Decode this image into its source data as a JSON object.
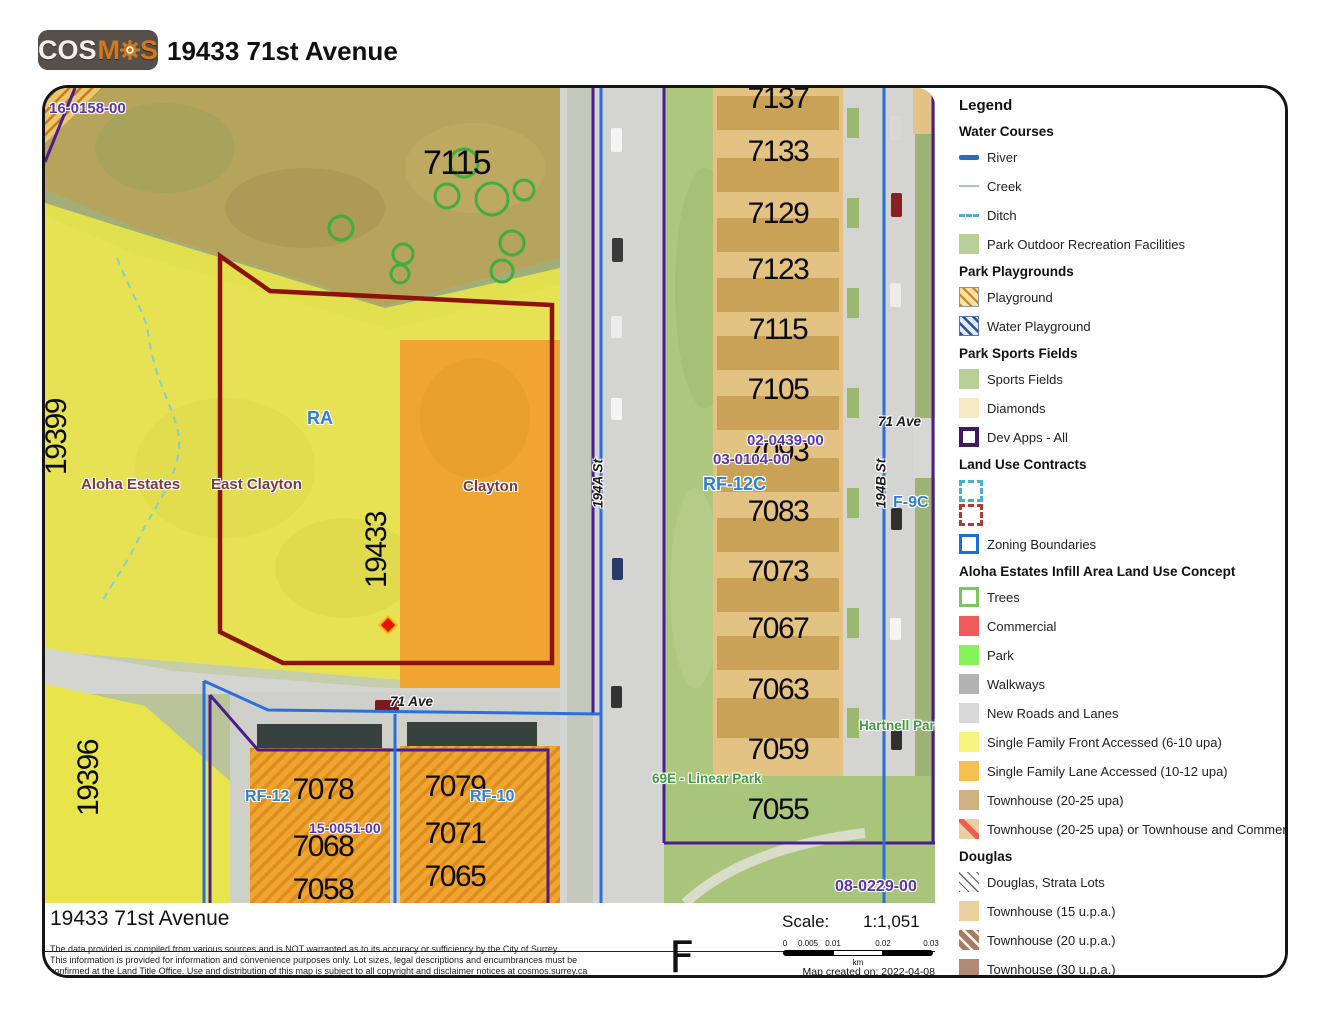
{
  "header": {
    "logo_part1": "COS",
    "logo_part2": "M",
    "logo_part3": "S",
    "title": "19433 71st Avenue"
  },
  "map": {
    "file_labels": {
      "nw": "16-0158-00",
      "c1": "02-0439-00",
      "c2": "03-0104-00",
      "sw": "15-0051-00",
      "se": "08-0229-00"
    },
    "zone_labels": {
      "ra": "RA",
      "rf12c": "RF-12C",
      "rf12": "RF-12",
      "rf10": "RF-10",
      "f9c": "F-9C"
    },
    "place_labels": {
      "aloha": "Aloha Estates",
      "east_clayton": "East Clayton",
      "clayton": "Clayton",
      "hartnell": "Hartnell Park",
      "linear_park": "69E - Linear Park"
    },
    "street_labels": {
      "s194a": "194A St",
      "s194b": "194B St",
      "ave71_right": "71 Ave",
      "ave71_bottom": "71 Ave"
    },
    "address_labels": {
      "a19399": "19399",
      "a19433": "19433",
      "a19396": "19396",
      "p7115_large": "7115"
    },
    "house_column": [
      "7137",
      "7133",
      "7129",
      "7123",
      "7115",
      "7105",
      "7093",
      "7083",
      "7073",
      "7067",
      "7063",
      "7059",
      "7055"
    ],
    "block_numbers": {
      "b7078": "7078",
      "b7068": "7068",
      "b7058": "7058",
      "b7079": "7079",
      "b7071": "7071",
      "b7065": "7065"
    }
  },
  "legend": {
    "title": "Legend",
    "sections": [
      {
        "header": "Water Courses",
        "items": [
          {
            "label": "River",
            "swatch": "river-line",
            "color": "#2b6cb8"
          },
          {
            "label": "Creek",
            "swatch": "creek-line",
            "color": "#9fc9d4"
          },
          {
            "label": "Ditch",
            "swatch": "ditch-dashed-line",
            "color": "#58a8da"
          },
          {
            "label": "Park Outdoor Recreation Facilities",
            "swatch": "fill",
            "color": "#b9cf97"
          }
        ]
      },
      {
        "header": "Park Playgrounds",
        "items": [
          {
            "label": "Playground",
            "swatch": "yellow-hatch",
            "color": "#f3e3a8"
          },
          {
            "label": "Water Playground",
            "swatch": "blue-hatch",
            "color": "#dfe9f5"
          }
        ]
      },
      {
        "header": "Park Sports Fields",
        "items": [
          {
            "label": "Sports Fields",
            "swatch": "fill",
            "color": "#b9cf97"
          },
          {
            "label": "Diamonds",
            "swatch": "fill",
            "color": "#f6ebc8"
          },
          {
            "label": "Dev Apps - All",
            "swatch": "outline",
            "color": "#42185e"
          }
        ]
      },
      {
        "header": "Land Use Contracts",
        "items": [
          {
            "label": "",
            "swatch": "dashed-outline",
            "color": "#49b0cf"
          },
          {
            "label": "",
            "swatch": "dashed-outline",
            "color": "#b03a34"
          },
          {
            "label": "Zoning Boundaries",
            "swatch": "outline",
            "color": "#1f6fd0"
          }
        ]
      },
      {
        "header": "Aloha Estates Infill Area Land Use Concept",
        "items": [
          {
            "label": "Trees",
            "swatch": "outline",
            "color": "#7cc45e"
          },
          {
            "label": "Commercial",
            "swatch": "fill",
            "color": "#f05c5c"
          },
          {
            "label": "Park",
            "swatch": "fill",
            "color": "#86f25c"
          },
          {
            "label": "Walkways",
            "swatch": "fill",
            "color": "#b3b3b3"
          },
          {
            "label": "New Roads and Lanes",
            "swatch": "fill",
            "color": "#d9d9d9"
          },
          {
            "label": "Single Family Front Accessed (6-10 upa)",
            "swatch": "fill",
            "color": "#f7f480"
          },
          {
            "label": "Single Family Lane Accessed (10-12 upa)",
            "swatch": "fill",
            "color": "#f6bf4f"
          },
          {
            "label": "Townhouse (20-25 upa)",
            "swatch": "fill",
            "color": "#cfb183"
          },
          {
            "label": "Townhouse (20-25 upa) or Townhouse and Commercial",
            "swatch": "red-stripe-on-tan",
            "color": "#e9cfa2"
          }
        ]
      },
      {
        "header": "Douglas",
        "items": [
          {
            "label": "Douglas, Strata Lots",
            "swatch": "thin-black-hatch",
            "color": "#ffffff"
          },
          {
            "label": "Townhouse (15 u.p.a.)",
            "swatch": "fill",
            "color": "#ead2a0"
          },
          {
            "label": "Townhouse (20 u.p.a.)",
            "swatch": "brown-hatch",
            "color": "#a87d5f"
          },
          {
            "label": "Townhouse (30 u.p.a.)",
            "swatch": "fill",
            "color": "#b08a77"
          },
          {
            "label": "",
            "swatch": "fill",
            "color": "#ead2a0"
          }
        ]
      }
    ]
  },
  "footer": {
    "title": "19433 71st Avenue",
    "scale_label": "Scale:",
    "scale_value": "1:1,051",
    "disclaimer_line1": "The data provided is compiled from various sources and is NOT warranted as to its accuracy or sufficiency by the City of Surrey.",
    "disclaimer_line2": "This information is provided for information and convenience purposes only.  Lot sizes, legal descriptions and encumbrances must be",
    "disclaimer_line3": "confirmed at the Land Title Office.  Use and distribution of this map is subject to all copyright and disclaimer notices at cosmos.surrey.ca",
    "north_glyph": "F",
    "scalebar": {
      "ticks": [
        "0",
        "0.005",
        "0.01",
        "0.02",
        "0.03"
      ],
      "unit": "km"
    },
    "created": "Map created on: 2022-04-08"
  },
  "colors": {
    "subject_boundary_red": "#8d1209",
    "dev_apps_purple": "#4b1e8f",
    "zoning_blue": "#2970dd",
    "file_label_purple": "#5a35b0",
    "zone_label_blue": "#2f7fd6",
    "place_label_red": "#7d3a3a",
    "park_label_green": "#3f9b3f",
    "single_family_yellow": "#e8e44c",
    "single_family_orange": "#f0a431",
    "logo_orange": "#d4781e",
    "tree_circle_green": "#3fae3f",
    "marker_red": "#e31010"
  }
}
